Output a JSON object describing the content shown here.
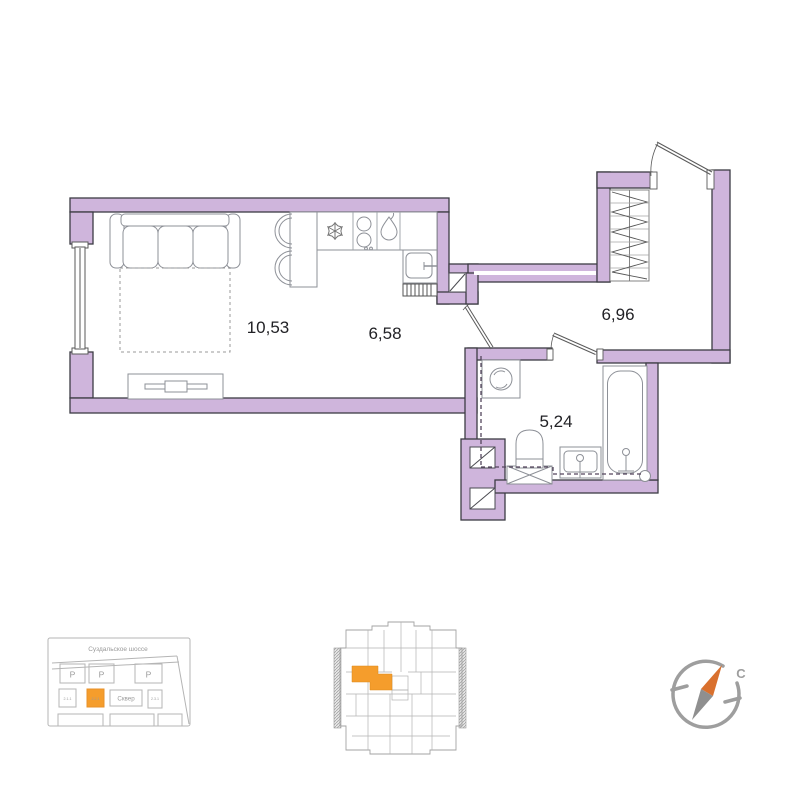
{
  "plan": {
    "rooms": [
      {
        "name": "living-room",
        "area": "10,53"
      },
      {
        "name": "kitchen",
        "area": "6,58"
      },
      {
        "name": "hallway",
        "area": "6,96"
      },
      {
        "name": "bathroom",
        "area": "5,24"
      }
    ]
  },
  "icons": {
    "fridge-icon": "snowflake-glyph",
    "stove-icon": "two-burner-circles",
    "water-heater-icon": "flame-drop",
    "vent-icon": "square-with-diagonal",
    "compass-needle-icon": "north-arrow"
  },
  "site_map": {
    "street": "Суздальское шоссе",
    "park": "Сквер",
    "parking": "P",
    "lots": [
      "2.1.1",
      "2.2.1",
      "2.3.1"
    ],
    "highlighted_lot": "2.2.1"
  },
  "compass": {
    "north": "С"
  },
  "colors": {
    "wall": "#cfb5dc",
    "highlight": "#f59d2c",
    "needle": "#d9702e"
  }
}
